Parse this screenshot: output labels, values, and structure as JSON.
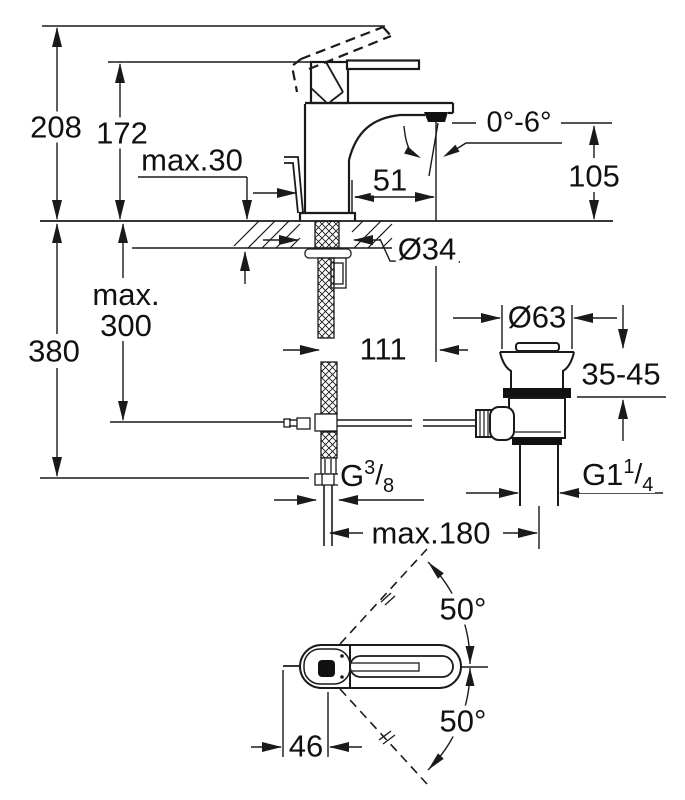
{
  "drawing": {
    "type": "technical-dimension-drawing",
    "subject": "single-lever-basin-mixer-with-pop-up-waste",
    "colors": {
      "line": "#1a1a1a",
      "background": "#ffffff",
      "text": "#111111"
    }
  },
  "labels": {
    "overall_height": "208",
    "body_height": "172",
    "deck_max": "max.30",
    "spout_reach": "51",
    "stream_angle": "0°-6°",
    "spout_height": "105",
    "hole_dia": "Ø34",
    "hose_max_line1": "max.",
    "hose_max_line2": "300",
    "clearance_height": "380",
    "center_to_stream": "111",
    "waste_flange_dia": "Ø63",
    "basin_range": "35-45",
    "supply_thread": {
      "g": "G",
      "num": "3",
      "slash": "/",
      "den": "8"
    },
    "waste_thread": {
      "g": "G1",
      "num": "1",
      "slash": "/",
      "den": "4"
    },
    "max_distance": "max.180",
    "swivel_up": "50°",
    "swivel_down": "50°",
    "handle_width": "46"
  }
}
